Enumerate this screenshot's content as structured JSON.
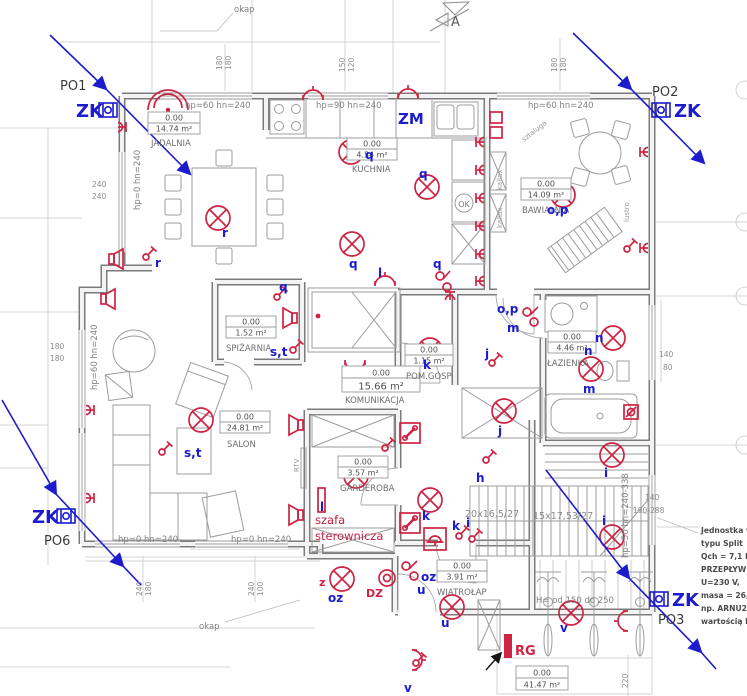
{
  "colors": {
    "symbol_red": "#ce2343",
    "electrical_blue": "#1c1ccd",
    "wall_gray": "#7b7b7b",
    "annotation_gray": "#8c8c8c"
  },
  "rooms": [
    {
      "name": "JADALNIA",
      "level": "0.00",
      "area": "14.74 m²"
    },
    {
      "name": "KUCHNIA",
      "level": "0.00",
      "area": "4.54 m²"
    },
    {
      "name": "BAWIALNIA",
      "level": "0.00",
      "area": "14.09 m²"
    },
    {
      "name": "SPIŻARNIA",
      "level": "0.00",
      "area": "1.52 m²"
    },
    {
      "name": "SALON",
      "level": "0.00",
      "area": "24.81 m²"
    },
    {
      "name": "KOMUNIKACJA",
      "level": "0.00",
      "area": "15.66 m²"
    },
    {
      "name": "POM.GOSP",
      "level": "0.00",
      "area": "1.15 m²"
    },
    {
      "name": "ŁAZIENKA",
      "level": "0.00",
      "area": "4.46 m²"
    },
    {
      "name": "GARDEROBA",
      "level": "0.00",
      "area": "3.57 m²"
    },
    {
      "name": "WIATROŁAP",
      "level": "0.00",
      "area": "3.91 m²"
    },
    {
      "name": "",
      "level": "0.00",
      "area": "41.47 m²"
    }
  ],
  "markers": {
    "zk": "ZK",
    "po1": "PO1",
    "po2": "PO2",
    "po3": "PO3",
    "po6": "PO6",
    "section": "A"
  },
  "wall_labels": {
    "top_left": "hp=60 hn=240",
    "top_mid": "hp=90 hn=240",
    "top_right": "hp=60 hn=240",
    "left_jadalnia": "hp=0 hn=240",
    "left_salon": "hp=60 hn=240",
    "bottom_a": "hp=0 hn=240",
    "bottom_b": "hp=0 hn=240",
    "stairs": "hp=50 hn=240-338"
  },
  "stairs": {
    "run1": "20x16,5/27",
    "run2": "15x17,53/27"
  },
  "notes": {
    "okap_top": "okap",
    "okap_bottom": "okap",
    "bikes": "H= od 150 do 250",
    "sztaluga": "sztaluga",
    "kallax1": "kallax",
    "kallax2": "kallax",
    "lustro": "lustro",
    "ok": "OK",
    "rtv": "RTV",
    "szafa_line1": "szafa",
    "szafa_line2": "sterownicza",
    "rg": "RG",
    "dz": "DZ",
    "zm": "ZM",
    "z": "z",
    "oz1": "oz",
    "oz2": "oz"
  },
  "unit_note": [
    "Jednostka we",
    "typu Split",
    "Qch = 7,1 kW",
    "PRZEPŁYW N",
    "U=230 V,",
    "masa = 26,5",
    "np. ARNU24G",
    "wartością ESP"
  ],
  "circuit_labels": [
    "r",
    "r",
    "q",
    "q",
    "q",
    "q",
    "q",
    "l",
    "l",
    "s,t",
    "s,t",
    "o,p",
    "o,p",
    "m",
    "m",
    "n",
    "n",
    "j",
    "j",
    "k",
    "k",
    "k",
    "i",
    "h",
    "i",
    "i",
    "u",
    "u",
    "v",
    "v"
  ],
  "dims": [
    "240",
    "240",
    "180",
    "180",
    "180",
    "180",
    "150",
    "120",
    "180",
    "180",
    "240",
    "180",
    "240",
    "100",
    "140",
    "80",
    "140",
    "190-288",
    "220"
  ]
}
